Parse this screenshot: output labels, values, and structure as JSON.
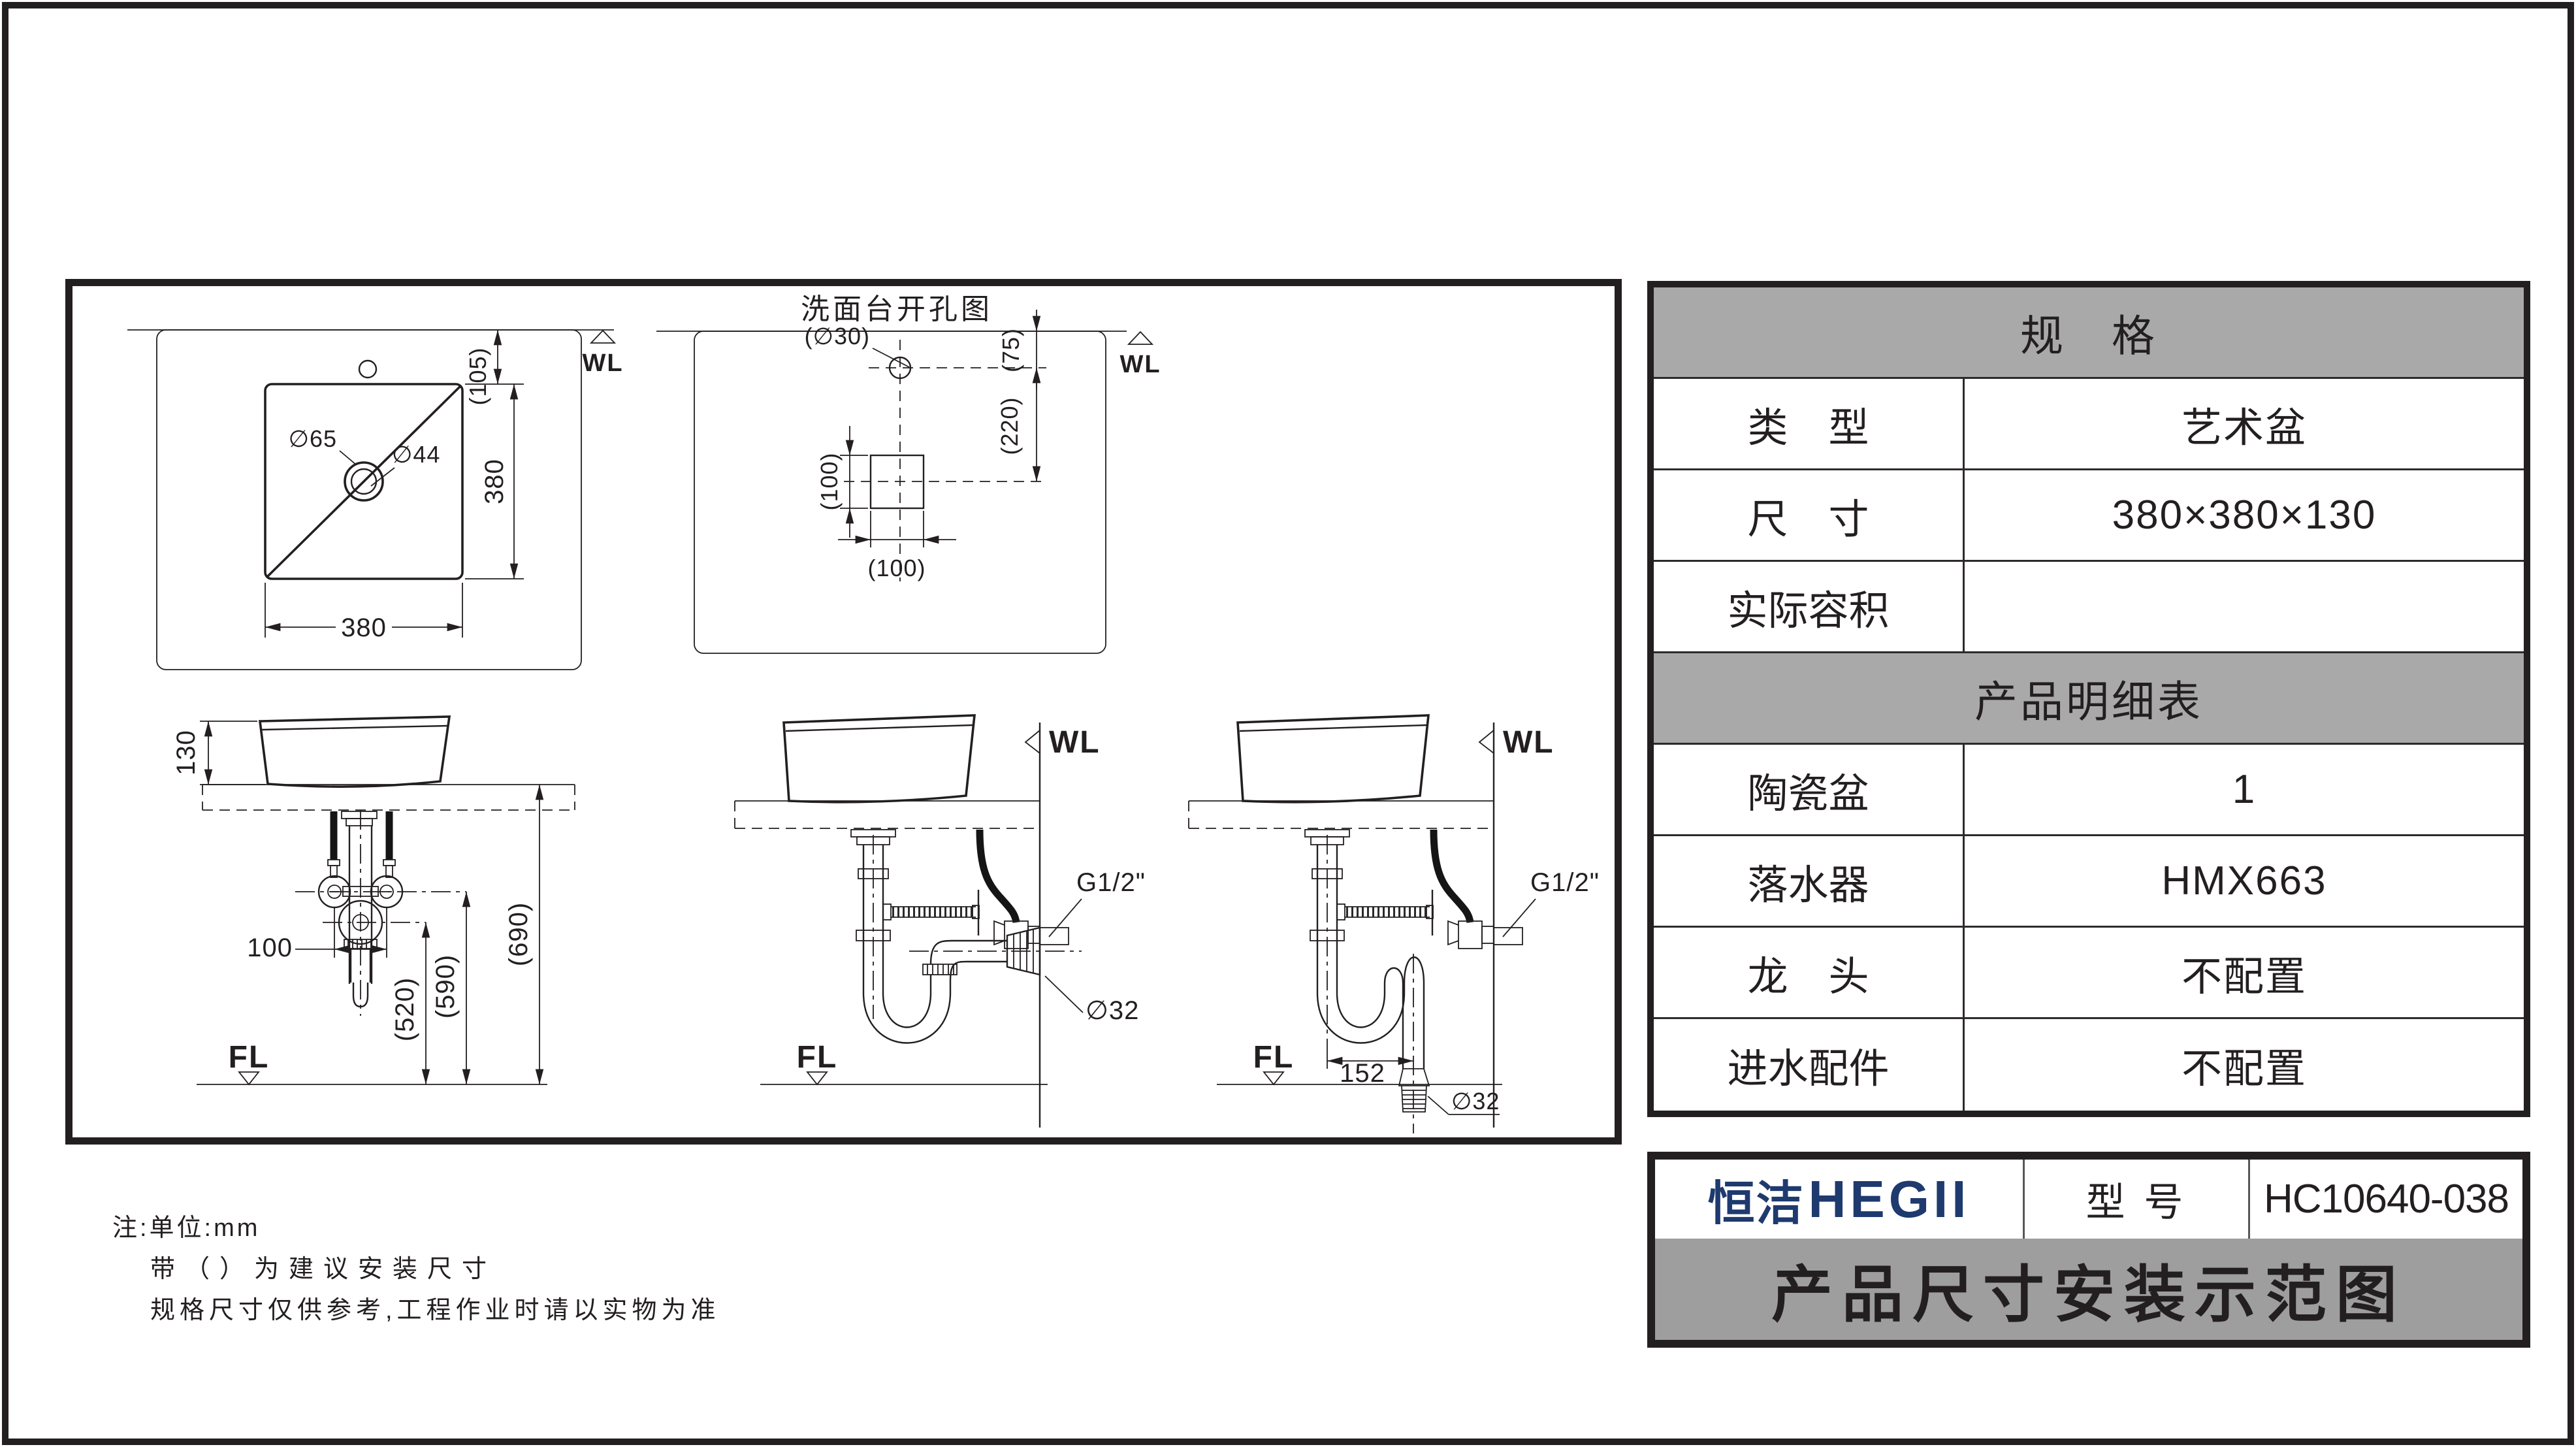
{
  "page": {
    "bg": "#ffffff",
    "line_color": "#231f20",
    "brand_navy": "#1e3a6e",
    "table_header_gray": "#a9a9a9",
    "banner_gray": "#9e9e9e"
  },
  "notes": {
    "line1": "注:单位:mm",
    "line2": "带（）为建议安装尺寸",
    "line3": "规格尺寸仅供参考,工程作业时请以实物为准"
  },
  "spec_table": {
    "title": "规　格",
    "rows": [
      {
        "label": "类　型",
        "value": "艺术盆"
      },
      {
        "label": "尺　寸",
        "value": "380×380×130"
      },
      {
        "label": "实际容积",
        "value": ""
      }
    ],
    "detail_title": "产品明细表",
    "detail_rows": [
      {
        "label": "陶瓷盆",
        "value": "1"
      },
      {
        "label": "落水器",
        "value": "HMX663"
      },
      {
        "label": "龙　头",
        "value": "不配置"
      },
      {
        "label": "进水配件",
        "value": "不配置"
      }
    ]
  },
  "title_block": {
    "brand_cn": "恒洁",
    "brand_en": "HEGII",
    "model_label": "型 号",
    "model_value": "HC10640-038",
    "doc_title": "产品尺寸安装示范图"
  },
  "drawings": {
    "top_view": {
      "wall_label": "WL",
      "dim_105": "(105)",
      "dim_right": "380",
      "dim_bottom": "380",
      "drain_outer": "∅65",
      "drain_inner": "∅44"
    },
    "hole_chart": {
      "title": "洗面台开孔图",
      "wall_label": "WL",
      "hole_label": "(∅30)",
      "dim_75": "(75)",
      "dim_220": "(220)",
      "dim_left": "(100)",
      "dim_bottom": "(100)"
    },
    "front_view": {
      "dim_130": "130",
      "dim_100": "100",
      "dim_520": "(520)",
      "dim_590": "(590)",
      "dim_690": "(690)",
      "floor_label": "FL"
    },
    "side_view_wall": {
      "wall_label": "WL",
      "floor_label": "FL",
      "thread_label": "G1/2\"",
      "outlet_label": "∅32"
    },
    "side_view_floor": {
      "wall_label": "WL",
      "floor_label": "FL",
      "thread_label": "G1/2\"",
      "outlet_label": "∅32",
      "dim_152": "152"
    }
  }
}
